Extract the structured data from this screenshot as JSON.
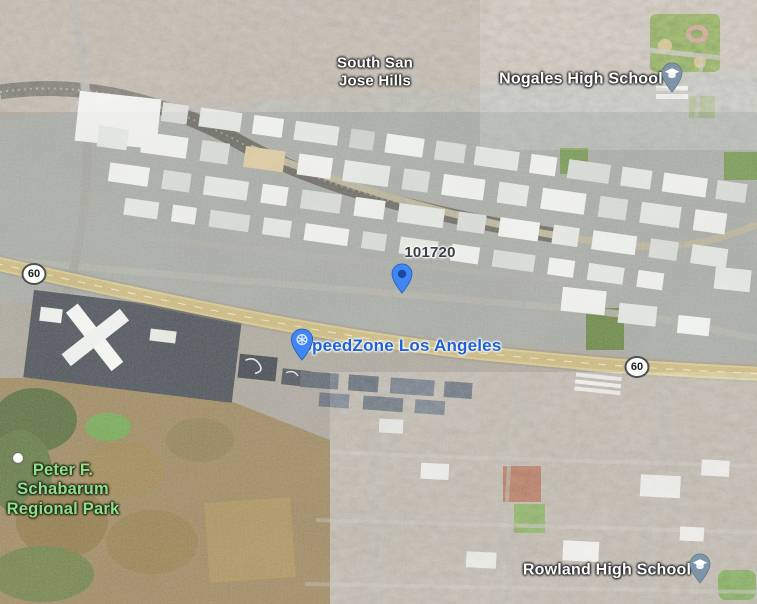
{
  "map": {
    "view": "satellite",
    "labels": {
      "neighborhood": {
        "name": "South San Jose Hills",
        "lines": [
          "South San",
          "Jose Hills"
        ]
      },
      "school_north": {
        "name": "Nogales High School"
      },
      "school_south": {
        "name": "Rowland High School"
      },
      "park": {
        "name": "Peter F. Schabarum Regional Park",
        "lines": [
          "Peter F.",
          "Schabarum",
          "Regional Park"
        ]
      },
      "poi": {
        "name": "SpeedZone Los Angeles"
      },
      "address": {
        "name": "101720"
      }
    },
    "route_shields": [
      {
        "text": "60"
      },
      {
        "text": "60"
      }
    ],
    "markers": [
      {
        "id": "nogales-school-pin",
        "icon": "graduation-cap",
        "color": "#7e95a8"
      },
      {
        "id": "address-pin",
        "icon": "dot",
        "color": "#4285f4"
      },
      {
        "id": "speedzone-pin",
        "icon": "attraction",
        "color": "#4285f4"
      },
      {
        "id": "rowland-school-pin",
        "icon": "graduation-cap",
        "color": "#7e95a8"
      },
      {
        "id": "trail-white-dot",
        "icon": "dot",
        "color": "#ffffff"
      }
    ],
    "colors": {
      "poi_label_blue": "#1f62d5",
      "park_label_green": "#92df8c",
      "place_label_white": "#ffffff",
      "address_label_dark": "#3c4043",
      "freeway_tan": "#d2c188",
      "school_pin_slate": "#7e95a8",
      "pin_blue": "#4285f4"
    }
  }
}
